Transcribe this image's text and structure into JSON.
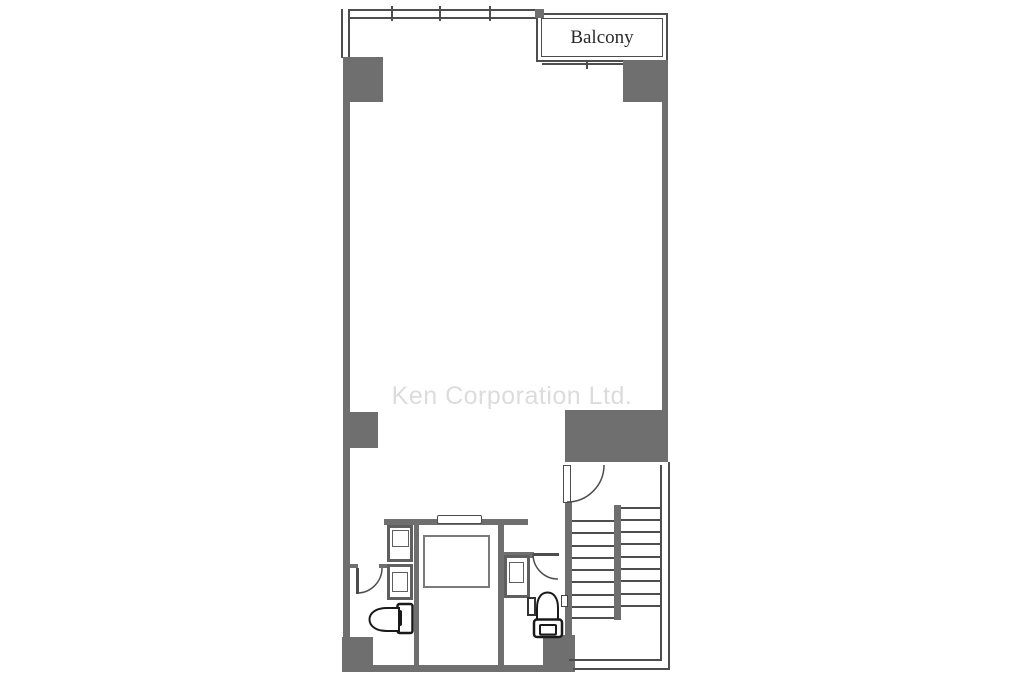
{
  "labels": {
    "balcony": "Balcony"
  },
  "watermark": {
    "text": "Ken Corporation Ltd."
  },
  "colors": {
    "wall": "#6f6f6f",
    "line": "#4d4d4d",
    "frame": "#5f5f5f",
    "fixture": "#1a1a1a",
    "watermark": "#dcdcdc",
    "balcony_text": "#2b2b2b",
    "bg": "#ffffff"
  },
  "stairs": {
    "right_tread_ys": [
      507,
      519,
      531,
      543,
      556,
      568,
      580,
      593,
      605
    ],
    "left_tread_ys": [
      520,
      532,
      545,
      557,
      569,
      581,
      594,
      606,
      617
    ]
  }
}
